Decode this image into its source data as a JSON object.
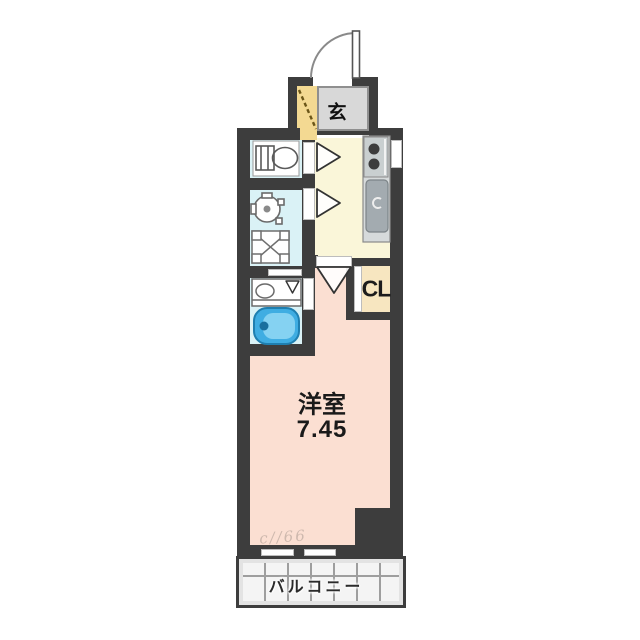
{
  "floorplan": {
    "kind": "apartment-floor-plan",
    "labels": {
      "entrance": "玄",
      "closet": "CL",
      "room_name": "洋室",
      "room_size": "7.45",
      "balcony": "バルコニー",
      "watermark": "c//66"
    },
    "rooms": [
      {
        "id": "entrance",
        "label": "玄",
        "fill": "#d8d8d8"
      },
      {
        "id": "kitchen",
        "fill": "#faf6d9"
      },
      {
        "id": "toilet",
        "fill": "#daf2f6"
      },
      {
        "id": "washroom",
        "fill": "#daf2f6"
      },
      {
        "id": "bathroom",
        "fill": "#daf2f6"
      },
      {
        "id": "western-room",
        "label": "洋室",
        "size_tatami": "7.45",
        "fill": "#fbdfd2"
      },
      {
        "id": "closet",
        "label": "CL",
        "fill": "#f7e6c0"
      },
      {
        "id": "balcony",
        "label": "バルコニー",
        "fill": "#e3e3e3"
      }
    ],
    "fixtures": [
      "entrance-door-swing",
      "toilet",
      "washbasin",
      "washing-machine-pan",
      "bathroom-counter",
      "bathtub",
      "stove-burners",
      "kitchen-sink",
      "door-swing-toilet",
      "door-swing-washroom",
      "door-swing-main-room",
      "folding-bath-door",
      "window-kitchen",
      "window-balcony-left",
      "window-balcony-right"
    ],
    "colors": {
      "wall": "#3d3d3d",
      "kitchen": "#faf6d9",
      "wet_area": "#daf2f6",
      "main_room": "#fbdfd2",
      "entrance_tile": "#d8d8d8",
      "entrance_step": "#f3d992",
      "closet": "#f7e6c0",
      "balcony": "#e3e3e3",
      "bathtub": "#41aede",
      "counter": "#c9cfd0"
    }
  }
}
